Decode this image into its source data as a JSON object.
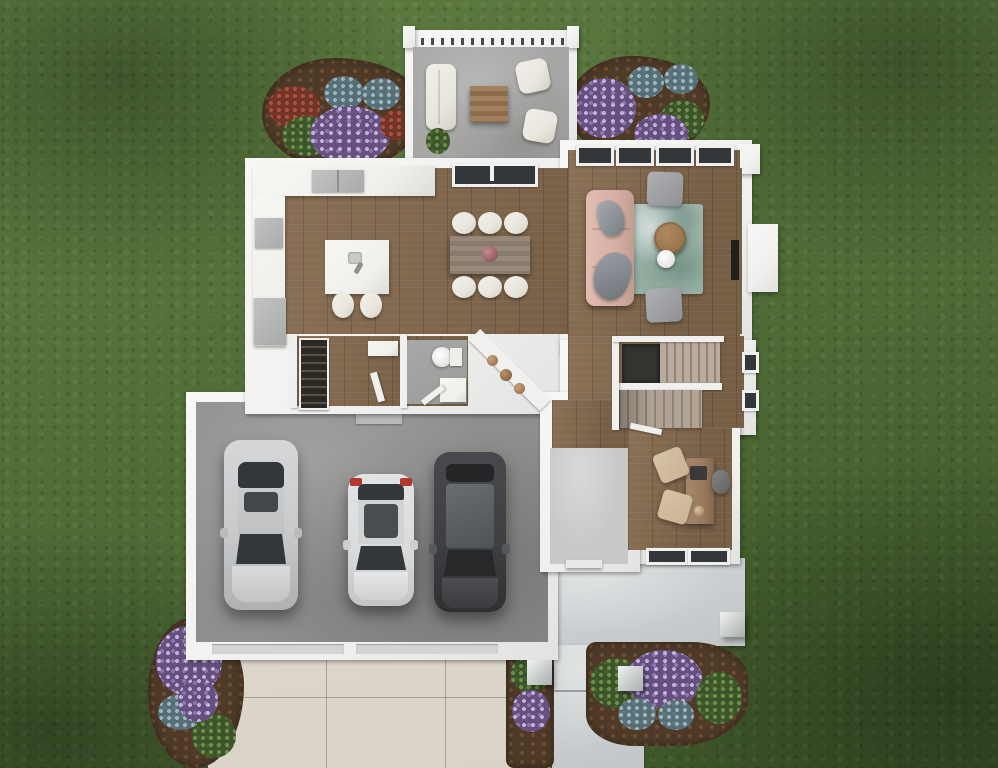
{
  "scene": {
    "type": "architectural-floor-plan-3d-render",
    "view": "top-down",
    "setting": "house first floor on grass lawn with driveway, front porch and rear patio",
    "text_content": "none (image contains no rendered text)"
  },
  "palette": {
    "grass": "#4e6a35",
    "grassLight": "#5e7d41",
    "grassDark": "#3c5428",
    "wall": "#f0f0ee",
    "woodA": "#8a7157",
    "woodB": "#775f46",
    "garage": "#8e8e8c",
    "bath": "#9b9b99",
    "foyer": "#c7c9c8",
    "porch": "#c2c6c8",
    "driveway": "#d9d3c7",
    "patio": "#a7a7a5",
    "mulch": "#4f3a28",
    "seatWhite": "#e9e6df",
    "counter": "#efefec",
    "appliance": "#a9abab",
    "sofaPink": "#d6b0a5",
    "rugTeal": "#a3b8ae",
    "tableWood": "#8d7e73",
    "deskWood": "#9a7b5f",
    "chairTan": "#c9b394",
    "carSilver": "#c7c9cb",
    "carWhite": "#dbdcdd",
    "carDark": "#3e4043",
    "glass": "#34373a",
    "taillight": "#b5372e",
    "fireplace": "#1f1f1d",
    "stairDark": "#35332f"
  },
  "rooms": [
    {
      "id": "rear-patio",
      "features": [
        "pergola",
        "outdoor-sofa",
        "coffee-table",
        "two-armchairs",
        "potted-plant"
      ]
    },
    {
      "id": "kitchen",
      "features": [
        "l-shaped-counter",
        "cooktop",
        "refrigerator",
        "island-with-two-stools"
      ]
    },
    {
      "id": "dining-area",
      "features": [
        "rectangular-table",
        "six-chairs",
        "centerpiece"
      ]
    },
    {
      "id": "living-room",
      "features": [
        "sofa",
        "two-armchairs",
        "area-rug",
        "round-coffee-table",
        "side-table",
        "fireplace"
      ]
    },
    {
      "id": "mudroom",
      "features": [
        "pantry-shelving",
        "bench",
        "door"
      ]
    },
    {
      "id": "bathroom",
      "features": [
        "toilet",
        "vanity"
      ]
    },
    {
      "id": "hallway",
      "features": [
        "diagonal-console-table",
        "decor-objects"
      ]
    },
    {
      "id": "staircase",
      "features": [
        "two-flights",
        "landing",
        "stairwell-void"
      ]
    },
    {
      "id": "office",
      "features": [
        "desk",
        "office-chair",
        "two-guest-chairs",
        "windows"
      ]
    },
    {
      "id": "garage",
      "features": [
        "three-cars",
        "two-garage-doors",
        "entry-step"
      ]
    },
    {
      "id": "foyer",
      "features": [
        "front-door",
        "tile-floor"
      ]
    },
    {
      "id": "front-porch",
      "features": [
        "three-columns",
        "walkway",
        "steps"
      ]
    }
  ],
  "vehicles": [
    {
      "id": "sedan",
      "color": "silver"
    },
    {
      "id": "compact-suv",
      "color": "white",
      "detail": "red-taillights"
    },
    {
      "id": "large-suv",
      "color": "dark-gray"
    }
  ],
  "landscaping": [
    {
      "id": "flower-bed-top-left",
      "plants": [
        "purple-flowers",
        "blue-green-shrubs",
        "red-flowers"
      ]
    },
    {
      "id": "flower-bed-right-of-patio",
      "plants": [
        "purple-flowers",
        "blue-green-shrubs"
      ]
    },
    {
      "id": "flower-bed-bottom-left",
      "plants": [
        "purple-flowers",
        "blue-green-shrub"
      ]
    },
    {
      "id": "flower-bed-front-porch",
      "plants": [
        "purple-flowers",
        "green-shrubs",
        "blue-green-shrubs"
      ]
    },
    {
      "id": "flower-bed-walkway",
      "plants": [
        "purple-flowers",
        "green-shrub"
      ]
    }
  ],
  "counts": {
    "dining_chairs": 6,
    "cars": 3,
    "porch_columns": 3,
    "living_room_windows": 4,
    "office_windows": 2
  }
}
